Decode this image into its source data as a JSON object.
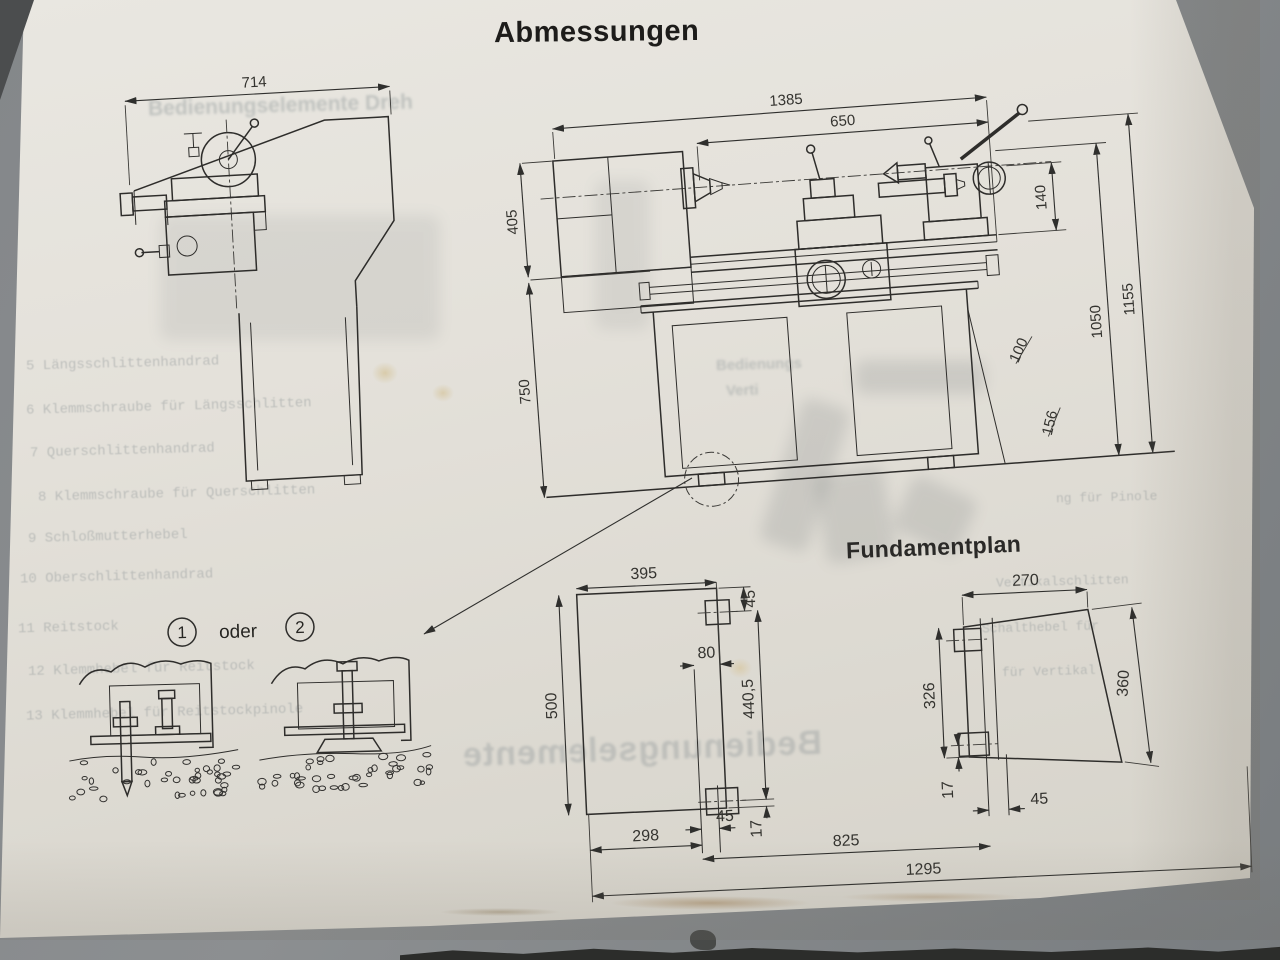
{
  "labels": {
    "title": "Abmessungen",
    "foundation_title": "Fundamentplan",
    "oder": "oder",
    "option1": "1",
    "option2": "2"
  },
  "dims": {
    "side_width": "714",
    "overall_length": "1385",
    "upper_length": "650",
    "height_upper": "405",
    "height_lower": "750",
    "tailstock_140": "140",
    "diag_100": "100",
    "height_1050": "1050",
    "height_1155": "1155",
    "base_156": "156"
  },
  "foundation": {
    "left_width": "395",
    "left_depth": "500",
    "top_offset_45": "45",
    "plate_80": "80",
    "bolt_span": "440,5",
    "edge_17_left": "17",
    "bottom_298": "298",
    "bottom_45_left": "45",
    "span_825": "825",
    "overall_1295": "1295",
    "right_width": "270",
    "right_depth_326": "326",
    "right_depth_360": "360",
    "edge_17_right": "17",
    "bottom_45_right": "45"
  },
  "bleed": {
    "header": "Bedienungselemente Dreh",
    "items": [
      {
        "text": "5  Längsschlittenhandrad"
      },
      {
        "text": "6  Klemmschraube für Längsschlitten"
      },
      {
        "text": "7  Querschlittenhandrad"
      },
      {
        "text": "8  Klemmschraube für Querschlitten"
      },
      {
        "text": "9  Schloßmutterhebel"
      },
      {
        "text": "10  Oberschlittenhandrad"
      },
      {
        "text": "11  Reitstock"
      },
      {
        "text": "12  Klemmhebel für Reitstock"
      },
      {
        "text": "13  Klemmhebel für Reitstockpinole"
      }
    ],
    "frag_bedienungs": "Bedienungs",
    "frag_verti": "Verti",
    "frag_pinole": "ng für Pinole",
    "frag_vertikalschlitten": "Vertikalschlitten",
    "frag_schalthebel": "Schalthebel für",
    "frag_fuer_vertikal": "für Vertikal",
    "mirrored": "Bedienungselemente"
  }
}
